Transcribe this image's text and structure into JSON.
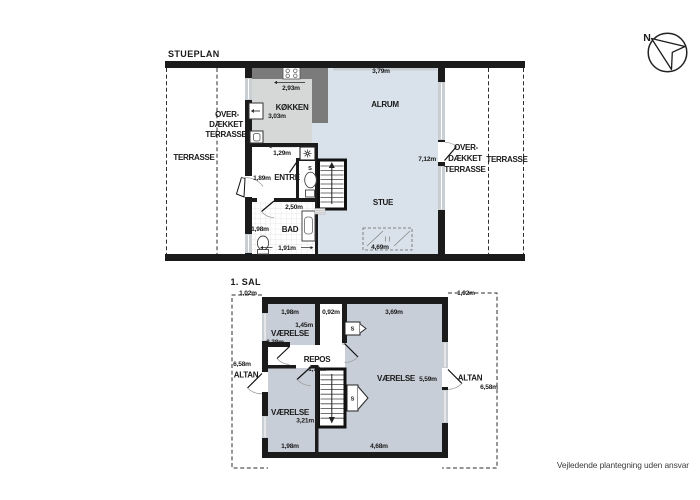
{
  "colors": {
    "wall": "#1b1b1b",
    "floor_main": "#d9e2ea",
    "floor_kitchen": "#d6d7d7",
    "floor_upper": "#c8ced8",
    "counter": "#7b7b7b",
    "window": "#c9ced3"
  },
  "compass": {
    "label": "N"
  },
  "footer": {
    "disclaimer": "Vejledende plantegning uden ansvar"
  },
  "stueplan": {
    "title": "STUEPLAN",
    "rooms": {
      "koekken": "KØKKEN",
      "alrum": "ALRUM",
      "entre": "ENTRÉ",
      "bad": "BAD",
      "stue": "STUE",
      "wc_closet": "S",
      "terrasse_left": "TERRASSE",
      "terrasse_right": "TERRASSE",
      "overdaekket_left": [
        "OVER-",
        "DÆKKET",
        "TERRASSE"
      ],
      "overdaekket_right": [
        "OVER-",
        "DÆKKET",
        "TERRASSE"
      ]
    },
    "dims": {
      "alrum_width": "3,79m",
      "koekken_width": "2,93m",
      "koekken_depth": "3,03m",
      "entre_width": "1,29m",
      "entre_depth": "1,89m",
      "entre_to_bad": "2,50m",
      "bad_depth": "1,98m",
      "bad_width": "1,91m",
      "stue_height": "7,12m",
      "skylight_width": "4,69m"
    }
  },
  "sal1": {
    "title": "1. SAL",
    "rooms": {
      "vaerelse_nw": "VÆRELSE",
      "vaerelse_e": "VÆRELSE",
      "vaerelse_sw": "VÆRELSE",
      "repos": "REPOS",
      "altan_left": "ALTAN",
      "altan_right": "ALTAN",
      "closet_hall": "S",
      "closet_stairs": "S"
    },
    "dims": {
      "altan_left_depth": "1,02m",
      "altan_left_length": "6,58m",
      "nw_width": "1,98m",
      "hall_width": "0,92m",
      "e_width_top": "3,69m",
      "nw_depth": "1,45m",
      "nw_depth_inner": "2,38m",
      "repos_width": "1,70m",
      "e_depth": "5,59m",
      "sw_depth": "3,21m",
      "sw_width": "1,98m",
      "e_width": "4,68m",
      "altan_right_depth": "1,92m",
      "altan_right_length": "6,58m"
    }
  }
}
